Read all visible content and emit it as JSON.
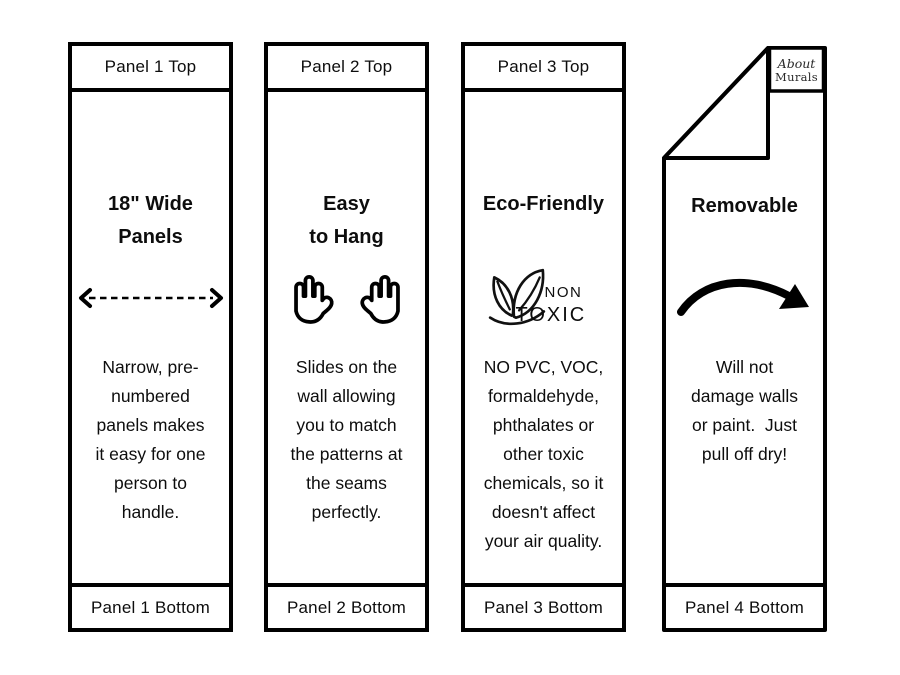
{
  "colors": {
    "ink": "#000000",
    "paper": "#ffffff",
    "text": "#0d0d0d"
  },
  "panels": [
    {
      "top_label": "Panel 1 Top",
      "heading": "18\" Wide\nPanels",
      "icon": "dashed-width-arrow",
      "body": "Narrow, pre-\nnumbered\npanels makes\nit easy for one\nperson to\nhandle.",
      "bottom_label": "Panel 1 Bottom"
    },
    {
      "top_label": "Panel 2 Top",
      "heading": "Easy\nto Hang",
      "icon": "two-open-hands",
      "body": "Slides on the\nwall allowing\nyou to match\nthe patterns at\nthe seams\nperfectly.",
      "bottom_label": "Panel 2 Bottom"
    },
    {
      "top_label": "Panel 3 Top",
      "heading": "Eco-Friendly",
      "icon": "non-toxic-leaves",
      "icon_text": {
        "non": "NON",
        "toxic": "TOXIC"
      },
      "body": "NO PVC, VOC,\nformaldehyde,\nphthalates or\nother toxic\nchemicals, so it\ndoesn't affect\nyour air quality.",
      "bottom_label": "Panel 3 Bottom"
    },
    {
      "heading": "Removable",
      "icon": "curved-swoosh-arrow",
      "logo": {
        "line1": "About",
        "line2": "Murals"
      },
      "body": "Will not\ndamage walls\nor paint.  Just\npull off dry!",
      "bottom_label": "Panel 4 Bottom"
    }
  ]
}
